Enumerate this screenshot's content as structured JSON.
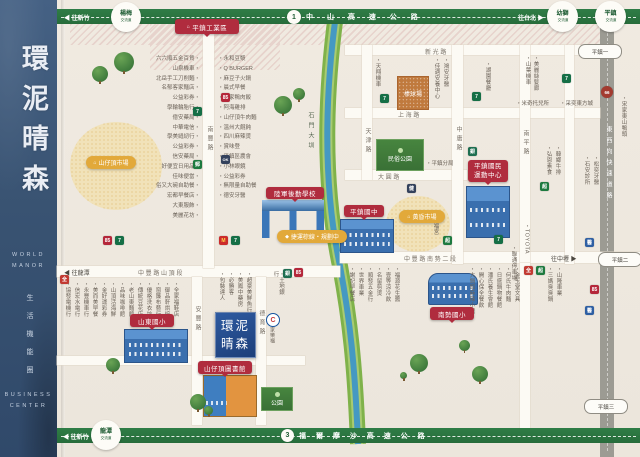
{
  "sidebar": {
    "title": "環泥晴森",
    "sub1": "WORLD",
    "sub2": "MANOR",
    "tagline": "生活機能圈",
    "foot1": "BUSINESS",
    "foot2": "CENTER"
  },
  "top_highway": {
    "dir_left": "◀ 往新竹",
    "name": "中 山 高 速 公 路",
    "shield": "1",
    "dir_right": "往台北 ▶",
    "ic_yangmei_1": "楊梅",
    "ic_yangmei_2": "交流道",
    "ic_youshi_1": "幼獅",
    "ic_youshi_2": "交流道",
    "ic_pingzhen_1": "平鎮",
    "ic_pingzhen_2": "交流道"
  },
  "bottom_highway": {
    "dir_left": "◀ 往新竹",
    "name": "福 爾 摩 沙 高 速 公 路",
    "shield": "3",
    "ic_longtan_1": "龍潭",
    "ic_longtan_2": "交流道"
  },
  "expressway": {
    "name": "東西向快速道路",
    "shield": "66",
    "exit1": "平鎮一",
    "exit2": "平鎮二",
    "exit3": "平鎮三",
    "dir": "往中壢 ▶"
  },
  "roads": {
    "nanfeng": "南豐路",
    "tianjin": "天津路",
    "zhongyong": "中庸路",
    "nanping": "南平路",
    "anfeng": "安豐路",
    "deyu": "德育路",
    "xinguang": "新 光 路",
    "shanghai": "上 海 路",
    "dayuan": "大 圓 路",
    "shanding": "中 豐 路 山 頂 段",
    "nanshi": "中 豐 路 南 勢 二 段",
    "to_longtan": "◀ 往龍潭",
    "to_zhongli": "往中壢 ▶",
    "canal": "石門大圳"
  },
  "badges": {
    "industrial": "平鎮工業區",
    "industrial_glyph": "⌂",
    "market_hilltop": "山仔頂市場",
    "market_evening": "黃昏市場",
    "market_glyph": "⌂",
    "folk_park": "民俗公園",
    "police": "・平鎮分局",
    "baseball": "棒球場",
    "sports1": "平鎮國民",
    "sports2": "運動中心",
    "army": "陸軍後勤學校",
    "mrt": "捷運棕線・規劃中",
    "mrt_glyph": "◆",
    "junior_high": "平鎮國中",
    "shandong": "山東國小",
    "library": "山仔頂圖書館",
    "nanshi_elem": "南勢國小",
    "park": "公園",
    "carrefour_c": "C",
    "carrefour": "家樂福"
  },
  "site": {
    "line1": "環泥",
    "line2": "晴森"
  },
  "lists": {
    "west": [
      "六六順五金百貨・",
      "山泉機車・",
      "北岳手工刀削麵・",
      "名郁客家麵店・",
      "公益彩券・",
      "學輪輪胎行・",
      "億安藥局・",
      "中華電信・",
      "學美縫紉行・",
      "公益彩券・",
      "信安藥局・",
      "好便宜日用品・",
      "佳味便當・",
      "俗又大碗自助餐・",
      "宏都早餐店・",
      "大東服飾・",
      "美麗花坊・"
    ],
    "east": [
      "・永和豆漿",
      "・Q BURGER",
      "・麻豆子火鍋",
      "・晨式早餐",
      "・吳家鴨肉飯",
      "・阿海雞排",
      "・山仔頂牛肉麵",
      "・溫州大餛飩",
      "・四川麻辣燙",
      "・賞味登",
      "・平鎮區農會",
      "・小林眼鏡",
      "・公益彩券",
      "・無限量自助餐",
      "・德安牙醫"
    ]
  },
  "places": [
    {
      "n": "shop-label",
      "c": "vs",
      "x": 64,
      "y": 281,
      "h": 46,
      "t": "・協發電機行"
    },
    {
      "n": "shop-label",
      "c": "vs",
      "x": 73,
      "y": 281,
      "h": 46,
      "t": "・信宏水電行"
    },
    {
      "n": "shop-label",
      "c": "vs",
      "x": 82,
      "y": 281,
      "h": 46,
      "t": "・永豐機車行"
    },
    {
      "n": "shop-label",
      "c": "vs",
      "x": 91,
      "y": 281,
      "h": 46,
      "t": "・美而美早餐"
    },
    {
      "n": "shop-label",
      "c": "vs",
      "x": 100,
      "y": 281,
      "h": 46,
      "t": "・金好運彩券"
    },
    {
      "n": "shop-label",
      "c": "vs",
      "x": 109,
      "y": 281,
      "h": 46,
      "t": "・山頂活海鮮"
    },
    {
      "n": "shop-label",
      "c": "vs",
      "x": 118,
      "y": 281,
      "h": 46,
      "t": "・品味咖啡館"
    },
    {
      "n": "shop-label",
      "c": "vs",
      "x": 127,
      "y": 281,
      "h": 46,
      "t": "・老山東麵館"
    },
    {
      "n": "shop-label",
      "c": "vs",
      "x": 136,
      "y": 281,
      "h": 46,
      "t": "・傳統豆花店"
    },
    {
      "n": "shop-label",
      "c": "vs",
      "x": 145,
      "y": 281,
      "h": 46,
      "t": "・優格洗衣坊"
    },
    {
      "n": "shop-label",
      "c": "vs",
      "x": 154,
      "y": 281,
      "h": 46,
      "t": "・窗簾布藝行"
    },
    {
      "n": "shop-label",
      "c": "vs",
      "x": 163,
      "y": 281,
      "h": 46,
      "t": "・御品軒烘焙"
    },
    {
      "n": "shop-label",
      "c": "vs",
      "x": 172,
      "y": 281,
      "h": 46,
      "t": "・全家福鞋店"
    },
    {
      "n": "shop-label",
      "c": "vs",
      "x": 218,
      "y": 271,
      "h": 42,
      "t": "・包裝達人"
    },
    {
      "n": "shop-label",
      "c": "vs",
      "x": 227,
      "y": 271,
      "h": 42,
      "t": "・必勝客"
    },
    {
      "n": "shop-label",
      "c": "vs",
      "x": 236,
      "y": 271,
      "h": 42,
      "t": "・美鳳中藥房"
    },
    {
      "n": "shop-label",
      "c": "vs",
      "x": 245,
      "y": 271,
      "h": 42,
      "t": "・超豪美鮮魚行"
    },
    {
      "n": "shop-label",
      "c": "vs",
      "x": 272,
      "y": 271,
      "h": 28,
      "t": "・土地銀行"
    },
    {
      "n": "shop-label",
      "c": "vs",
      "x": 348,
      "y": 266,
      "h": 48,
      "t": "・謝記早餐店"
    },
    {
      "n": "shop-label",
      "c": "vs",
      "x": 357,
      "y": 266,
      "h": 48,
      "t": "・世界車業"
    },
    {
      "n": "shop-label",
      "c": "vs",
      "x": 366,
      "y": 266,
      "h": 48,
      "t": "・順發五金行"
    },
    {
      "n": "shop-label",
      "c": "vs",
      "x": 375,
      "y": 266,
      "h": 48,
      "t": "・名留剪燙"
    },
    {
      "n": "shop-label",
      "c": "vs",
      "x": 384,
      "y": 266,
      "h": 48,
      "t": "・壹等涼冷飲"
    },
    {
      "n": "shop-label",
      "c": "vs",
      "x": 393,
      "y": 266,
      "h": 48,
      "t": "・福源花生醬"
    },
    {
      "n": "shop-label",
      "c": "vs",
      "x": 468,
      "y": 266,
      "h": 56,
      "t": "・大鍋頭麻辣小館"
    },
    {
      "n": "shop-label",
      "c": "vs",
      "x": 477,
      "y": 266,
      "h": 56,
      "t": "・開心保全餐飲"
    },
    {
      "n": "shop-label",
      "c": "vs",
      "x": 486,
      "y": 266,
      "h": 56,
      "t": "・潘氏養生會館"
    },
    {
      "n": "shop-label",
      "c": "vs",
      "x": 495,
      "y": 266,
      "h": 56,
      "t": "・日盛鍋物餐館"
    },
    {
      "n": "shop-label",
      "c": "vs",
      "x": 504,
      "y": 266,
      "h": 56,
      "t": "・何氏牛肉麵"
    },
    {
      "n": "shop-label",
      "c": "vs",
      "x": 513,
      "y": 266,
      "h": 56,
      "t": "・金玉堂文具"
    },
    {
      "n": "shop-label",
      "c": "vs",
      "x": 546,
      "y": 266,
      "h": 36,
      "t": "・三媽臭臭鍋"
    },
    {
      "n": "shop-label",
      "c": "vs",
      "x": 555,
      "y": 266,
      "h": 36,
      "t": "・山隆車業"
    },
    {
      "n": "shop-label",
      "c": "vs",
      "x": 374,
      "y": 57,
      "h": 32,
      "t": "・天翔機車"
    },
    {
      "n": "shop-label",
      "c": "vs",
      "x": 433,
      "y": 57,
      "h": 42,
      "t": "・佳適安養中心"
    },
    {
      "n": "shop-label",
      "c": "vs",
      "x": 442,
      "y": 57,
      "h": 34,
      "t": "・鴻安牙醫"
    },
    {
      "n": "shop-label",
      "c": "vs",
      "x": 484,
      "y": 61,
      "h": 30,
      "t": "・湖園餐廳"
    },
    {
      "n": "shop-label",
      "c": "vs",
      "x": 524,
      "y": 55,
      "h": 30,
      "t": "・山葉機車"
    },
    {
      "n": "shop-label",
      "c": "vs",
      "x": 532,
      "y": 55,
      "h": 36,
      "t": "・美麗絲髮廊"
    },
    {
      "n": "shop-label",
      "c": "vs",
      "x": 620,
      "y": 95,
      "h": 44,
      "t": "・宋家東山鴨頭"
    },
    {
      "n": "shop-label",
      "c": "hs",
      "x": 516,
      "y": 99,
      "w": 42,
      "t": "・米奇托兒所"
    },
    {
      "n": "shop-label",
      "c": "hs",
      "x": 560,
      "y": 99,
      "w": 42,
      "t": "・采奕東方城"
    },
    {
      "n": "shop-label",
      "c": "vs",
      "x": 545,
      "y": 145,
      "h": 30,
      "t": "・弘恩素食"
    },
    {
      "n": "shop-label",
      "c": "vs",
      "x": 554,
      "y": 145,
      "h": 30,
      "t": "・韓鄉牛排"
    },
    {
      "n": "shop-label",
      "c": "vs",
      "x": 583,
      "y": 155,
      "h": 30,
      "t": "・石安診所"
    },
    {
      "n": "shop-label",
      "c": "vs",
      "x": 592,
      "y": 155,
      "h": 30,
      "t": "・松奕牙醫"
    },
    {
      "n": "shop-label",
      "c": "vs",
      "x": 432,
      "y": 211,
      "h": 26,
      "t": "・五福宮"
    },
    {
      "n": "shop-label",
      "c": "vs",
      "x": 510,
      "y": 245,
      "h": 38,
      "t": "・聯通停車場"
    },
    {
      "n": "shop-label",
      "c": "vs",
      "x": 523,
      "y": 223,
      "h": 32,
      "t": "・TOYOTA"
    },
    {
      "n": "seven-eleven-icon",
      "c": "poi",
      "x": 193,
      "y": 107,
      "t": "7",
      "bg": "#156f46"
    },
    {
      "n": "post-office-icon",
      "c": "poi",
      "x": 193,
      "y": 160,
      "t": "郵",
      "bg": "#1d7a3f"
    },
    {
      "n": "85c-cafe-icon",
      "c": "poi",
      "x": 221,
      "y": 93,
      "t": "85",
      "bg": "#b5273a"
    },
    {
      "n": "ok-mart-icon",
      "c": "poi",
      "x": 221,
      "y": 155,
      "t": "OK",
      "bg": "#33415c",
      "fs": 4
    },
    {
      "n": "mcdonalds-icon",
      "c": "poi",
      "x": 219,
      "y": 236,
      "t": "M",
      "bg": "#cc2b2b",
      "fg": "#ffd34d"
    },
    {
      "n": "seven-eleven-icon",
      "c": "poi",
      "x": 231,
      "y": 236,
      "t": "7",
      "bg": "#156f46"
    },
    {
      "n": "85c-cafe-icon",
      "c": "poi",
      "x": 103,
      "y": 236,
      "t": "85",
      "bg": "#b5273a"
    },
    {
      "n": "seven-eleven-icon",
      "c": "poi",
      "x": 115,
      "y": 236,
      "t": "7",
      "bg": "#156f46"
    },
    {
      "n": "pxmart-icon",
      "c": "poi",
      "x": 60,
      "y": 275,
      "t": "全",
      "bg": "#c23a32"
    },
    {
      "n": "seven-eleven-icon",
      "c": "poi",
      "x": 380,
      "y": 94,
      "t": "7",
      "bg": "#156f46"
    },
    {
      "n": "seven-eleven-icon",
      "c": "poi",
      "x": 472,
      "y": 92,
      "t": "7",
      "bg": "#156f46"
    },
    {
      "n": "seven-eleven-icon",
      "c": "poi",
      "x": 562,
      "y": 74,
      "t": "7",
      "bg": "#156f46"
    },
    {
      "n": "seven-eleven-icon",
      "c": "poi",
      "x": 494,
      "y": 235,
      "t": "7",
      "bg": "#156f46"
    },
    {
      "n": "pxmart-icon",
      "c": "poi",
      "x": 524,
      "y": 266,
      "t": "全",
      "bg": "#c23a32"
    },
    {
      "n": "supermarket-icon",
      "c": "poi",
      "x": 536,
      "y": 266,
      "t": "超",
      "bg": "#1d7a3f"
    },
    {
      "n": "bank-icon",
      "c": "poi",
      "x": 283,
      "y": 269,
      "t": "銀",
      "bg": "#1d6e50"
    },
    {
      "n": "85c-cafe-icon",
      "c": "poi",
      "x": 294,
      "y": 268,
      "t": "85",
      "bg": "#b5273a"
    },
    {
      "n": "bank-icon",
      "c": "poi",
      "x": 468,
      "y": 147,
      "t": "銀",
      "bg": "#1d6e50"
    },
    {
      "n": "supermarket-icon",
      "c": "poi",
      "x": 443,
      "y": 236,
      "t": "超",
      "bg": "#1d7a3f"
    },
    {
      "n": "fitness-icon",
      "c": "poi",
      "x": 407,
      "y": 184,
      "t": "健",
      "bg": "#33415c"
    },
    {
      "n": "85c-cafe-icon",
      "c": "poi",
      "x": 590,
      "y": 285,
      "t": "85",
      "bg": "#b5273a"
    },
    {
      "n": "clinic-icon",
      "c": "poi",
      "x": 585,
      "y": 238,
      "t": "醫",
      "bg": "#2e5fa3"
    },
    {
      "n": "clinic-icon",
      "c": "poi",
      "x": 585,
      "y": 306,
      "t": "醫",
      "bg": "#2e5fa3"
    },
    {
      "n": "supermarket-icon",
      "c": "poi",
      "x": 540,
      "y": 182,
      "t": "超",
      "bg": "#1d7a3f"
    },
    {
      "n": "expressway-shield",
      "c": "poi rshield",
      "x": 601,
      "y": 86,
      "w": 12,
      "h": 12,
      "t": "66",
      "bg": "#a33b30",
      "fs": 4.5
    },
    {
      "n": "tree",
      "c": "tree",
      "x": 92,
      "y": 66,
      "w": 16,
      "h": 16
    },
    {
      "n": "tree",
      "c": "tree",
      "x": 114,
      "y": 52,
      "w": 20,
      "h": 20
    },
    {
      "n": "tree",
      "c": "tree",
      "x": 274,
      "y": 96,
      "w": 18,
      "h": 18
    },
    {
      "n": "tree",
      "c": "tree",
      "x": 293,
      "y": 88,
      "w": 12,
      "h": 12
    },
    {
      "n": "tree",
      "c": "tree",
      "x": 106,
      "y": 358,
      "w": 14,
      "h": 14
    },
    {
      "n": "tree",
      "c": "tree",
      "x": 190,
      "y": 394,
      "w": 16,
      "h": 16
    },
    {
      "n": "tree",
      "c": "tree",
      "x": 204,
      "y": 406,
      "w": 9,
      "h": 9
    },
    {
      "n": "tree",
      "c": "tree",
      "x": 410,
      "y": 354,
      "w": 18,
      "h": 18
    },
    {
      "n": "tree",
      "c": "tree",
      "x": 472,
      "y": 366,
      "w": 16,
      "h": 16
    },
    {
      "n": "tree",
      "c": "tree",
      "x": 400,
      "y": 372,
      "w": 7,
      "h": 7
    },
    {
      "n": "tree",
      "c": "tree",
      "x": 459,
      "y": 340,
      "w": 11,
      "h": 11
    }
  ]
}
